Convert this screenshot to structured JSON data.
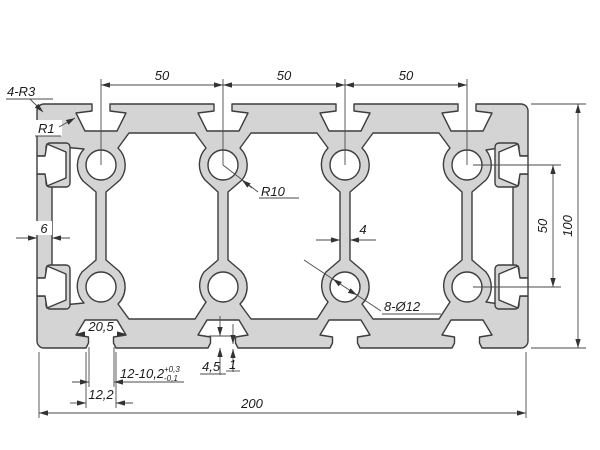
{
  "drawing": {
    "dims": {
      "top_spans": [
        "50",
        "50",
        "50"
      ],
      "right_span": "50",
      "height": "100",
      "width": "200",
      "wall": "6",
      "web": "4",
      "slot_cavity": "20,5",
      "slot_series": "12-10,2",
      "tol_plus": "+0,3",
      "tol_minus": "-0,1",
      "slot_mouth": "12,2",
      "lip_depth": "4,5",
      "lip_step": "1"
    },
    "labels": {
      "corner_radius": "4-R3",
      "lip_radius": "R1",
      "cavity_radius": "R10",
      "holes": "8-Ø12"
    },
    "colors": {
      "profile_fill": "#d4d4d4",
      "cavity_fill": "#ffffff",
      "outline": "#3d3d3d",
      "dim_line": "#4a4a4a"
    }
  }
}
